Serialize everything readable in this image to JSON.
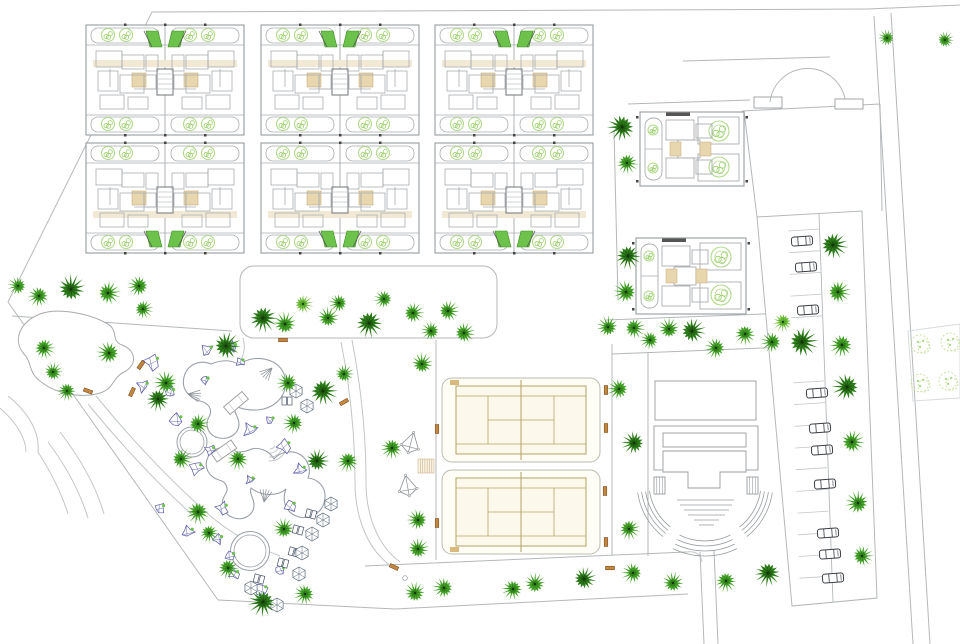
{
  "canvas": {
    "width": 960,
    "height": 644
  },
  "colors": {
    "background": "#ffffff",
    "road_line": "#b4b8ba",
    "path_line": "#c2c6c8",
    "wall_gray": "#989da0",
    "maze_gray": "#a8adb0",
    "tree_dark": "#2e7d1c",
    "tree_dark_inner": "#205c10",
    "tree_mid": "#45a32a",
    "tree_mid_inner": "#2f7d18",
    "tree_light": "#6fc13e",
    "tree_light_inner": "#52a326",
    "tree_core": "#12380a",
    "shrub_outline": "#b2d98c",
    "bush_outline": "#c9e2a0",
    "court_line": "#b3a464",
    "court_fill": "#fcf9ec",
    "enclosure_line": "#b9bcb0",
    "beige_band": "#f1e9d4",
    "beige_block": "#e7d6ae",
    "beige_edge": "#c7ab77",
    "green_accent": "#6cc24a",
    "green_accent_edge": "#3e8e20",
    "bench_fill": "#c2863e",
    "bench_edge": "#6e4215",
    "rock_line": "#5a5aa8",
    "car_line": "#3a3f44",
    "water_line": "#9aa0a8",
    "dark_tick": "#444444"
  },
  "site": {
    "roads": [
      [
        152,
        12,
        868,
        9
      ],
      [
        868,
        9,
        960,
        5
      ],
      [
        152,
        12,
        8,
        302
      ],
      [
        8,
        302,
        218,
        600
      ],
      [
        218,
        600,
        395,
        609
      ],
      [
        395,
        609,
        688,
        594
      ],
      [
        874,
        16,
        913,
        644
      ],
      [
        891,
        13,
        930,
        644
      ],
      [
        683,
        61,
        830,
        57
      ],
      [
        742,
        111,
        880,
        104
      ],
      [
        744,
        111,
        757,
        217
      ],
      [
        880,
        104,
        882,
        211
      ],
      [
        614,
        130,
        618,
        300
      ],
      [
        606,
        320,
        788,
        313
      ],
      [
        612,
        354,
        788,
        347
      ],
      [
        628,
        104,
        750,
        100
      ],
      [
        436,
        340,
        436,
        560
      ],
      [
        612,
        344,
        612,
        556
      ],
      [
        648,
        352,
        648,
        556
      ],
      [
        365,
        566,
        686,
        552
      ],
      [
        700,
        552,
        704,
        644
      ],
      [
        714,
        550,
        718,
        644
      ],
      [
        12,
        316,
        232,
        331
      ],
      [
        792,
        606,
        877,
        598
      ]
    ],
    "curves": [
      "M352,340 C362,392 366,442 366,482 C366,516 378,546 400,562",
      "M341,342 C351,392 355,442 355,482 C355,518 368,550 391,566",
      "M96,396 C132,440 170,480 206,512 C228,532 254,546 280,556",
      "M88,404 C124,448 162,488 198,520",
      "M60,432 C80,458 96,486 104,514",
      "M48,442 C66,466 80,492 88,518",
      "M38,452 C52,474 62,494 68,514",
      "M8,396 C28,412 40,432 38,452",
      "M0,408 C16,422 26,438 26,452",
      "M243,338 C247,352 241,364 231,372",
      "M686,552 Q700,550 702,562"
    ],
    "planting_strip": [
      240,
      266,
      257,
      72,
      14
    ],
    "pond_path": "M40,314 C20,322 12,340 24,354 C32,362 28,372 40,381 C54,393 80,399 100,393 C114,389 112,378 124,372 C138,365 136,350 122,345 C110,341 120,330 106,323 C90,314 58,307 40,314 Z",
    "entrance": {
      "posts": [
        [
          754,
          97,
          28,
          11
        ],
        [
          835,
          99,
          28,
          10
        ]
      ],
      "arc": "M770,102 A38,38 0 0 1 845,99"
    },
    "bush_area": "M908,331 L960,324 L960,398 L913,401 Z"
  },
  "buildings": {
    "apartment_block_size": {
      "w": 158,
      "h": 110
    },
    "apartment_blocks": [
      {
        "x": 86,
        "y": 25,
        "variant": "green-top"
      },
      {
        "x": 261,
        "y": 25,
        "variant": "green-top"
      },
      {
        "x": 435,
        "y": 25,
        "variant": "green-top"
      },
      {
        "x": 86,
        "y": 143,
        "variant": "green-bottom"
      },
      {
        "x": 261,
        "y": 143,
        "variant": "green-bottom"
      },
      {
        "x": 435,
        "y": 143,
        "variant": "green-bottom"
      }
    ],
    "duplex_buildings": [
      [
        640,
        112,
        104,
        74
      ],
      [
        636,
        238,
        110,
        76
      ]
    ]
  },
  "recreation": {
    "tennis": {
      "enclosure": {
        "w": 158,
        "h": 84
      },
      "courts": [
        [
          442,
          378
        ],
        [
          442,
          470
        ]
      ]
    },
    "amphitheater": {
      "top_rect": [
        655,
        381,
        101,
        39
      ],
      "stage_rect": [
        654,
        426,
        104,
        44
      ],
      "inner_rect": [
        663,
        433,
        83,
        14
      ],
      "t_shape": "M663,451 h83 v21 h-26 v16 h-32 v-16 h-25 Z",
      "hatch_left": [
        654,
        477,
        11,
        17
      ],
      "hatch_right": [
        747,
        477,
        11,
        17
      ],
      "rows": [
        [
          677,
          500,
          57
        ],
        [
          680,
          505,
          52
        ],
        [
          684,
          510,
          45
        ],
        [
          688,
          515,
          37
        ],
        [
          694,
          520,
          25
        ],
        [
          699,
          525,
          15
        ]
      ],
      "arc_center": [
        705,
        483
      ],
      "bank_radii": [
        56,
        60,
        64,
        68
      ],
      "bottom_radii": [
        58,
        63,
        68,
        73
      ],
      "left_angles": [
        128,
        172
      ],
      "right_angles": [
        8,
        52
      ],
      "bottom_angles": [
        64,
        116
      ]
    },
    "pool": {
      "lagoon_a": "M211,364 C199,359 187,365 184,377 C181,389 189,398 200,401 C209,403 213,410 209,417 C204,426 209,436 219,438 C230,440 239,433 239,424 C239,417 233,412 235,406 C251,413 269,411 279,400 C290,388 287,369 273,362 C261,356 247,358 239,365 C231,359 221,360 211,364 Z",
      "lagoon_b": "M237,452 C227,444 213,447 208,457 C203,467 209,477 219,480 C227,482 229,489 225,495 C219,504 224,515 234,518 C245,521 254,514 254,505 C254,498 249,494 251,488 C261,496 277,497 286,489 C281,502 287,514 299,517 C312,520 324,511 325,498 C326,487 318,479 308,478 C312,468 307,457 297,453 C288,450 279,453 274,459 C269,450 257,446 249,450 C245,452 241,452 237,452 Z",
      "round_pool": [
        192,
        442,
        15,
        12
      ],
      "kiddie_pool": [
        250,
        551,
        19.5,
        16
      ],
      "bridges": [
        [
          236,
          403,
          -40
        ],
        [
          224,
          451,
          -35
        ]
      ],
      "fans": [
        [
          272,
          368,
          135
        ],
        [
          188,
          394,
          10
        ],
        [
          264,
          502,
          280
        ]
      ],
      "stair_arcs": [
        270,
        444
      ]
    },
    "kites": [
      [
        410,
        446,
        15
      ],
      [
        408,
        489,
        -10
      ]
    ],
    "deck": [
      418,
      459
    ]
  },
  "parking": {
    "outline": "M757,217 L862,211 L877,598 L792,606 Z",
    "lane": [
      819,
      214,
      833,
      602
    ],
    "stalls": {
      "y0": 231,
      "y1": 590,
      "step": 21.7,
      "skip": [
        320,
        372
      ]
    },
    "cars": [
      [
        802,
        241,
        -4
      ],
      [
        806,
        267,
        -4
      ],
      [
        808,
        310,
        -4
      ],
      [
        817,
        393,
        -4
      ],
      [
        820,
        428,
        -4
      ],
      [
        822,
        450,
        -4
      ],
      [
        825,
        484,
        -4
      ],
      [
        828,
        533,
        -4
      ],
      [
        830,
        554,
        -4
      ],
      [
        833,
        578,
        -4
      ]
    ]
  },
  "vegetation": {
    "trees": [
      [
        887,
        38,
        "m",
        8
      ],
      [
        945,
        40,
        "m",
        8
      ],
      [
        622,
        127,
        "d",
        13
      ],
      [
        627,
        163,
        "m",
        10
      ],
      [
        628,
        256,
        "d",
        12
      ],
      [
        626,
        292,
        "m",
        11
      ],
      [
        608,
        327,
        "m",
        10
      ],
      [
        634,
        328,
        "m",
        10
      ],
      [
        650,
        340,
        "m",
        9
      ],
      [
        669,
        329,
        "m",
        10
      ],
      [
        692,
        331,
        "d",
        12
      ],
      [
        716,
        348,
        "m",
        10
      ],
      [
        745,
        334,
        "m",
        10
      ],
      [
        772,
        342,
        "m",
        10
      ],
      [
        263,
        318,
        "d",
        13
      ],
      [
        285,
        324,
        "m",
        11
      ],
      [
        303,
        304,
        "l",
        9
      ],
      [
        328,
        318,
        "m",
        10
      ],
      [
        339,
        303,
        "m",
        9
      ],
      [
        369,
        323,
        "d",
        13
      ],
      [
        384,
        299,
        "m",
        9
      ],
      [
        413,
        313,
        "m",
        10
      ],
      [
        431,
        331,
        "m",
        9
      ],
      [
        448,
        311,
        "m",
        10
      ],
      [
        464,
        333,
        "m",
        10
      ],
      [
        18,
        286,
        "m",
        9
      ],
      [
        39,
        296,
        "m",
        10
      ],
      [
        71,
        289,
        "d",
        13
      ],
      [
        108,
        293,
        "m",
        11
      ],
      [
        139,
        286,
        "m",
        10
      ],
      [
        143,
        309,
        "m",
        9
      ],
      [
        44,
        348,
        "m",
        10
      ],
      [
        109,
        353,
        "m",
        11
      ],
      [
        53,
        372,
        "m",
        9
      ],
      [
        67,
        391,
        "m",
        9
      ],
      [
        226,
        346,
        "d",
        13
      ],
      [
        166,
        383,
        "m",
        11
      ],
      [
        158,
        399,
        "d",
        11
      ],
      [
        198,
        424,
        "m",
        10
      ],
      [
        181,
        459,
        "m",
        10
      ],
      [
        238,
        459,
        "m",
        10
      ],
      [
        288,
        383,
        "m",
        10
      ],
      [
        323,
        391,
        "d",
        13
      ],
      [
        294,
        423,
        "m",
        10
      ],
      [
        317,
        461,
        "d",
        11
      ],
      [
        344,
        374,
        "m",
        9
      ],
      [
        348,
        461,
        "m",
        10
      ],
      [
        198,
        512,
        "m",
        11
      ],
      [
        228,
        568,
        "m",
        10
      ],
      [
        263,
        602,
        "d",
        13
      ],
      [
        284,
        529,
        "m",
        10
      ],
      [
        305,
        594,
        "m",
        10
      ],
      [
        209,
        533,
        "m",
        9
      ],
      [
        422,
        364,
        "m",
        10
      ],
      [
        392,
        448,
        "m",
        10
      ],
      [
        418,
        520,
        "m",
        10
      ],
      [
        619,
        389,
        "m",
        10
      ],
      [
        634,
        443,
        "d",
        11
      ],
      [
        629,
        529,
        "m",
        10
      ],
      [
        418,
        549,
        "m",
        10
      ],
      [
        415,
        593,
        "m",
        10
      ],
      [
        444,
        588,
        "m",
        10
      ],
      [
        513,
        589,
        "m",
        10
      ],
      [
        535,
        584,
        "m",
        10
      ],
      [
        584,
        579,
        "d",
        11
      ],
      [
        633,
        573,
        "m",
        10
      ],
      [
        673,
        583,
        "m",
        10
      ],
      [
        726,
        581,
        "m",
        10
      ],
      [
        768,
        573,
        "d",
        12
      ],
      [
        783,
        322,
        "l",
        9
      ],
      [
        802,
        342,
        "d",
        14
      ],
      [
        833,
        245,
        "d",
        13
      ],
      [
        838,
        292,
        "m",
        11
      ],
      [
        842,
        345,
        "m",
        11
      ],
      [
        847,
        387,
        "d",
        13
      ],
      [
        852,
        442,
        "m",
        11
      ],
      [
        858,
        503,
        "m",
        11
      ],
      [
        862,
        556,
        "m",
        10
      ]
    ],
    "bushes": [
      [
        920,
        344
      ],
      [
        950,
        342
      ],
      [
        920,
        383
      ],
      [
        948,
        381
      ]
    ],
    "rocks": [
      [
        152,
        362,
        9
      ],
      [
        143,
        386,
        7
      ],
      [
        176,
        420,
        8
      ],
      [
        207,
        350,
        7
      ],
      [
        232,
        347,
        6
      ],
      [
        250,
        430,
        8
      ],
      [
        284,
        446,
        8
      ],
      [
        300,
        470,
        7
      ],
      [
        196,
        468,
        8
      ],
      [
        222,
        508,
        7
      ],
      [
        160,
        508,
        6
      ],
      [
        188,
        532,
        7
      ],
      [
        218,
        539,
        6
      ],
      [
        290,
        506,
        7
      ],
      [
        261,
        590,
        8
      ],
      [
        234,
        574,
        6
      ],
      [
        170,
        392,
        6
      ],
      [
        205,
        380,
        5
      ],
      [
        240,
        362,
        5
      ],
      [
        270,
        420,
        5
      ],
      [
        210,
        450,
        6
      ],
      [
        250,
        480,
        5
      ],
      [
        230,
        556,
        6
      ],
      [
        280,
        570,
        6
      ]
    ]
  },
  "furniture": {
    "benches": [
      [
        283,
        340,
        0
      ],
      [
        141,
        365,
        -55
      ],
      [
        132,
        392,
        -65
      ],
      [
        88,
        391,
        20
      ],
      [
        344,
        402,
        -30
      ],
      [
        437,
        429,
        90
      ],
      [
        437,
        523,
        90
      ],
      [
        606,
        390,
        90
      ],
      [
        606,
        428,
        90
      ],
      [
        605,
        491,
        90
      ],
      [
        606,
        542,
        90
      ],
      [
        394,
        567,
        25
      ],
      [
        610,
        568,
        0
      ]
    ],
    "loungers": [
      [
        287,
        401,
        0
      ],
      [
        311,
        514,
        15
      ],
      [
        298,
        530,
        15
      ],
      [
        294,
        552,
        15
      ],
      [
        259,
        579,
        15
      ],
      [
        283,
        563,
        15
      ]
    ],
    "umbrellas": [
      [
        296,
        391
      ],
      [
        307,
        406
      ],
      [
        331,
        504
      ],
      [
        323,
        520
      ],
      [
        312,
        534
      ],
      [
        302,
        553
      ],
      [
        299,
        574
      ],
      [
        251,
        588
      ],
      [
        277,
        605
      ]
    ],
    "dots": [
      [
        405,
        578
      ]
    ]
  }
}
